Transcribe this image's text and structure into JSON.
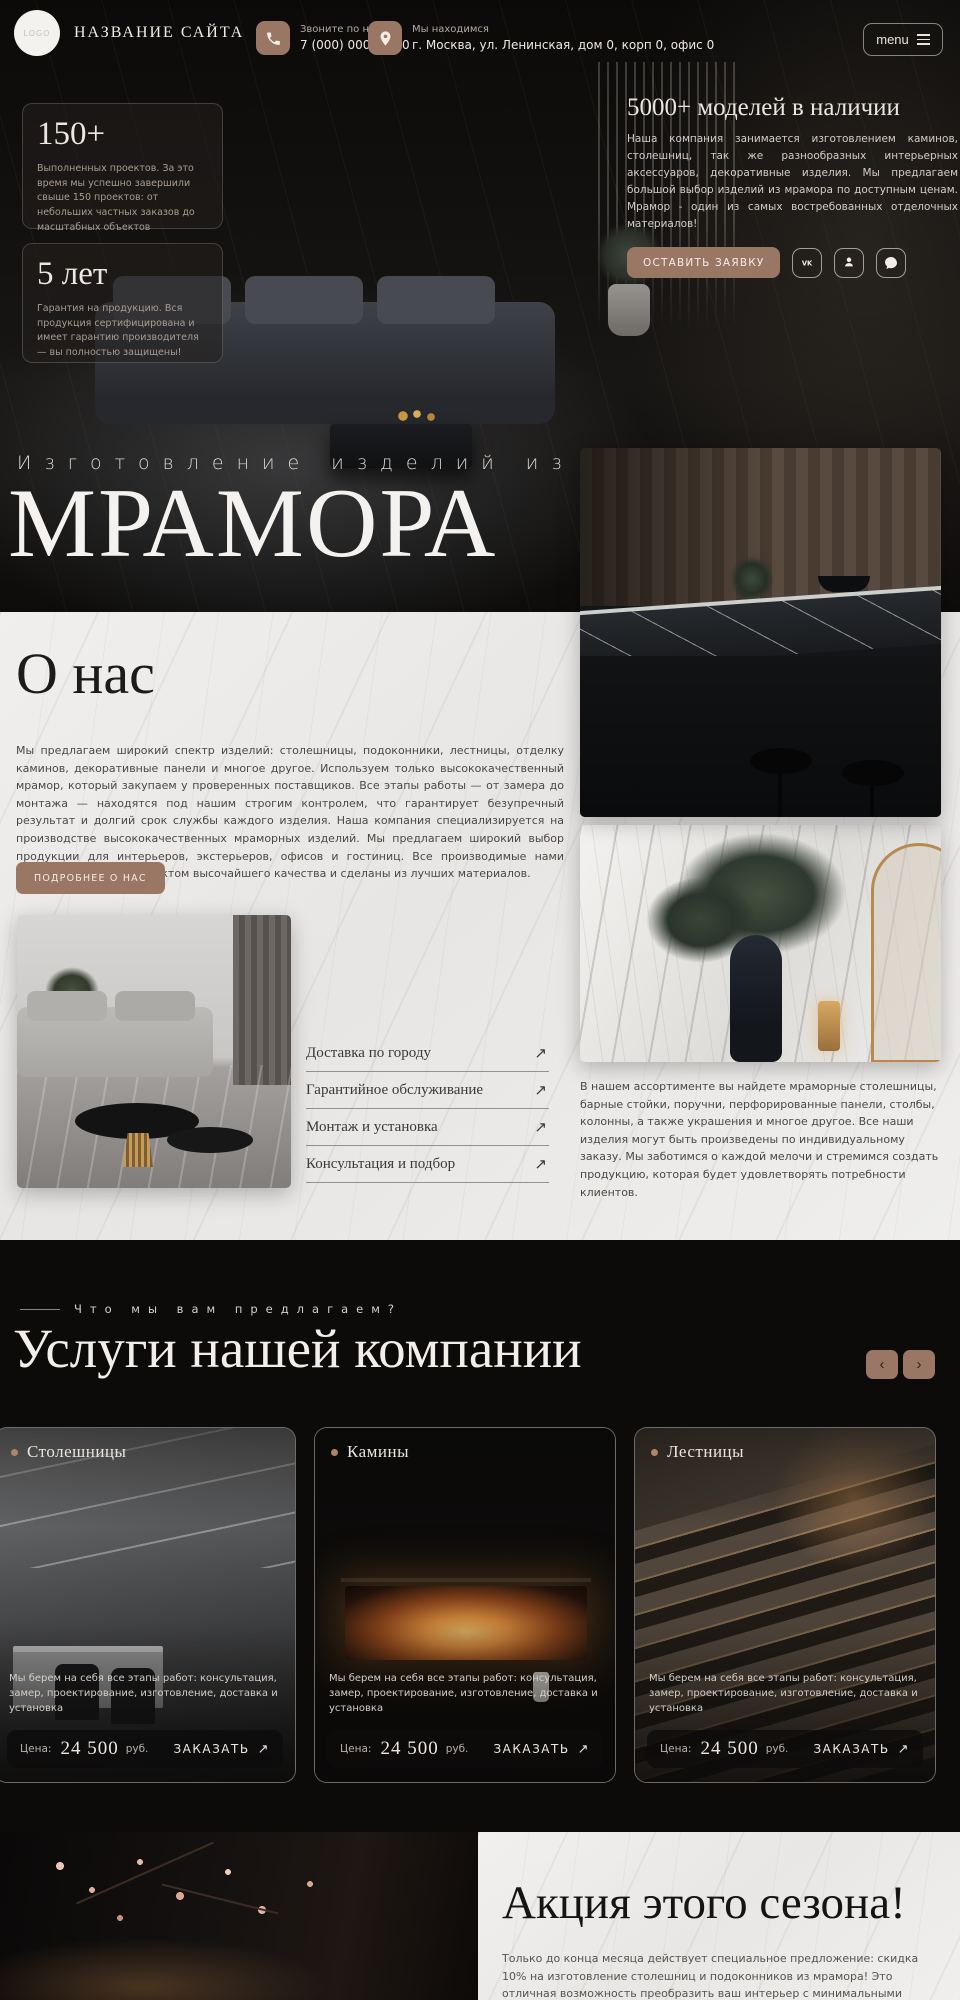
{
  "header": {
    "logo": "LOGO",
    "site_name": "НАЗВАНИЕ САЙТА",
    "phone_label": "Звоните по номеру",
    "phone_number": "7 (000) 000-00-00",
    "address_label": "Мы находимся",
    "address_value": "г. Москва, ул. Ленинская, дом 0, корп 0, офис 0",
    "menu_label": "menu"
  },
  "hero": {
    "stat_cards": [
      {
        "value": "150+",
        "text": "Выполненных проектов. За это время мы успешно завершили свыше 150 проектов: от небольших частных заказов до масштабных объектов"
      },
      {
        "value": "5 лет",
        "text": "Гарантия на продукцию. Вся продукция сертифицирована и имеет гарантию производителя — вы полностью защищены!"
      }
    ],
    "offer_title": "5000+ моделей в наличии",
    "offer_text": "Наша компания занимается изготовлением каминов, столешниц, так же разнообразных интерьерных аксессуаров, декоративные изделия. Мы предлагаем большой выбор изделий из мрамора по доступным ценам. Мрамор - один из самых востребованных отделочных материалов!",
    "cta_label": "ОСТАВИТЬ ЗАЯВКУ",
    "socials": [
      "vk",
      "odnoklassniki",
      "messenger"
    ],
    "title_small": "Изготовление изделий из",
    "title_big": "МРАМОРА"
  },
  "about": {
    "title": "О нас",
    "text": "Мы предлагаем широкий спектр изделий: столешницы, подоконники, лестницы, отделку каминов, декоративные панели и многое другое. Используем только высококачественный мрамор, который закупаем у проверенных поставщиков. Все этапы работы — от замера до монтажа — находятся под нашим строгим контролем, что гарантирует безупречный результат и долгий срок службы каждого изделия. Наша компания специализируется на производстве высококачественных мраморных изделий. Мы предлагаем широкий выбор продукции для интерьеров, экстерьеров, офисов и гостиниц. Все производимые нами изделия являются продуктом высочайшего качества и сделаны из лучших материалов.",
    "cta_label": "ПОДРОБНЕЕ О НАС",
    "services_links": [
      {
        "label": "Доставка по городу"
      },
      {
        "label": "Гарантийное обслуживание"
      },
      {
        "label": "Монтаж и установка"
      },
      {
        "label": "Консультация и подбор"
      }
    ],
    "assortment_text": "В нашем ассортименте вы найдете мраморные столешницы, барные стойки, поручни, перфорированные панели, столбы, колонны, а также украшения и многое другое. Все наши изделия могут быть произведены по индивидуальному заказу.  Мы заботимся о каждой мелочи и стремимся создать продукцию, которая будет удовлетворять потребности клиентов."
  },
  "services_section": {
    "tagline": "Что мы вам предлагаем?",
    "title": "Услуги нашей компании",
    "cards": [
      {
        "title": "Столешницы",
        "text": "Мы берем на себя все этапы работ: консультация, замер, проектирование, изготовление, доставка и установка",
        "price_label": "Цена:",
        "price_value": "24 500",
        "price_units": "руб.",
        "cta": "ЗАКАЗАТЬ"
      },
      {
        "title": "Камины",
        "text": "Мы берем на себя все этапы работ: консультация, замер, проектирование, изготовление, доставка и установка",
        "price_label": "Цена:",
        "price_value": "24 500",
        "price_units": "руб.",
        "cta": "ЗАКАЗАТЬ"
      },
      {
        "title": "Лестницы",
        "text": "Мы берем на себя все этапы работ: консультация, замер, проектирование, изготовление, доставка и установка",
        "price_label": "Цена:",
        "price_value": "24 500",
        "price_units": "руб.",
        "cta": "ЗАКАЗАТЬ"
      }
    ]
  },
  "promo": {
    "title": "Акция этого сезона!",
    "text": "Только до конца месяца действует специальное предложение: скидка 10% на изготовление столешниц и подоконников из мрамора! Это отличная возможность преобразить ваш интерьер с минимальными затратами. Мы рады предложить изделия под заказ по"
  },
  "icons": {
    "arrow_up_right": "↗",
    "chevron_left": "‹",
    "chevron_right": "›"
  },
  "colors": {
    "accent": "#9a7765",
    "dark_background": "#0c0b0a",
    "light_background": "#edecea",
    "flame": "#ea9440"
  }
}
